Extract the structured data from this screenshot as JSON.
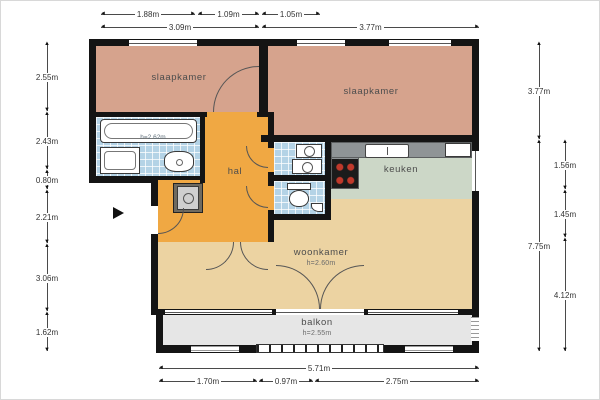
{
  "rooms": {
    "bedroom_left": {
      "label": "slaapkamer"
    },
    "bedroom_right": {
      "label": "slaapkamer"
    },
    "hall": {
      "label": "hal"
    },
    "kitchen": {
      "label": "keuken"
    },
    "living_room": {
      "label": "woonkamer",
      "ceiling_height": "h=2.60m"
    },
    "balcony": {
      "label": "balkon",
      "ceiling_height": "h=2.55m"
    },
    "bathroom": {
      "ceiling_height": "h=2.62m"
    }
  },
  "dimensions": {
    "top_row1": [
      "1.88m",
      "1.09m",
      "1.05m"
    ],
    "top_row2": [
      "3.09m",
      "3.77m"
    ],
    "left_column": [
      "2.55m",
      "2.43m",
      "0.80m",
      "2.21m",
      "3.06m",
      "1.62m"
    ],
    "right_outer": [
      "3.77m",
      "7.75m"
    ],
    "right_inner": [
      "1.56m",
      "1.45m",
      "4.12m"
    ],
    "bottom_total": "5.71m",
    "bottom_segments": [
      "1.70m",
      "0.97m",
      "2.75m"
    ]
  },
  "colors": {
    "wall": "#141414",
    "bedroom_floor": "#d6a38d",
    "hall_floor": "#f0a843",
    "kitchen_floor": "#ccd7c7",
    "living_floor": "#ecd3a2",
    "balcony_floor": "#e6e6e6",
    "tile_floor": "#b4d3e6",
    "counter": "#8f9496",
    "burner_red": "#c0392b"
  }
}
